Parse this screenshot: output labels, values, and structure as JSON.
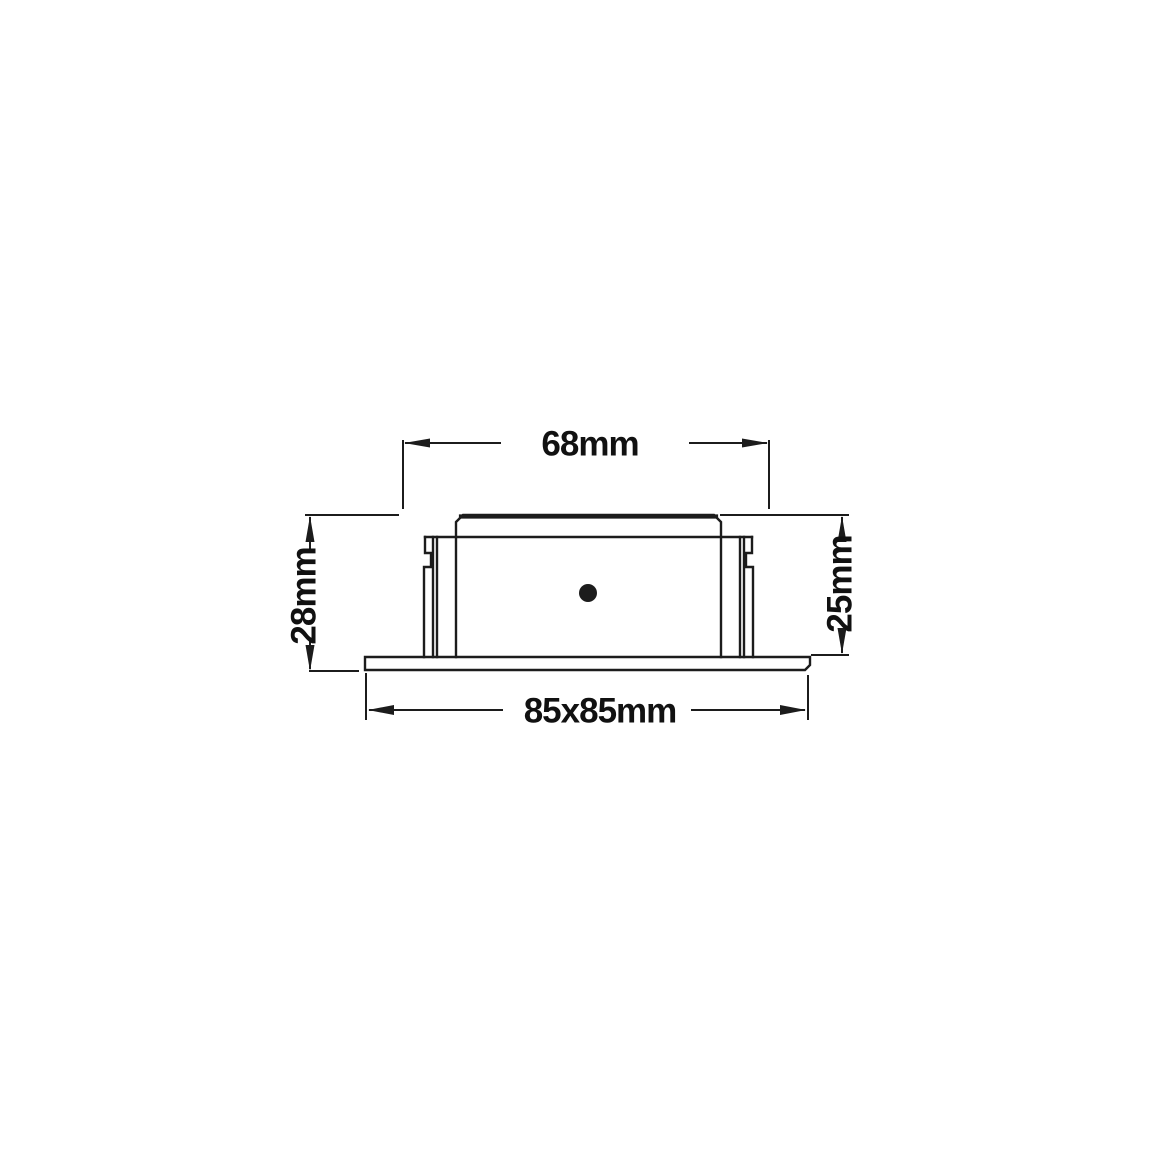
{
  "diagram": {
    "background_color": "#ffffff",
    "line_color": "#1c1c1c",
    "label_color": "#111111",
    "dimensions": {
      "top_width": "68mm",
      "left_height": "28mm",
      "right_height": "25mm",
      "bottom_footprint": "85x85mm"
    }
  }
}
